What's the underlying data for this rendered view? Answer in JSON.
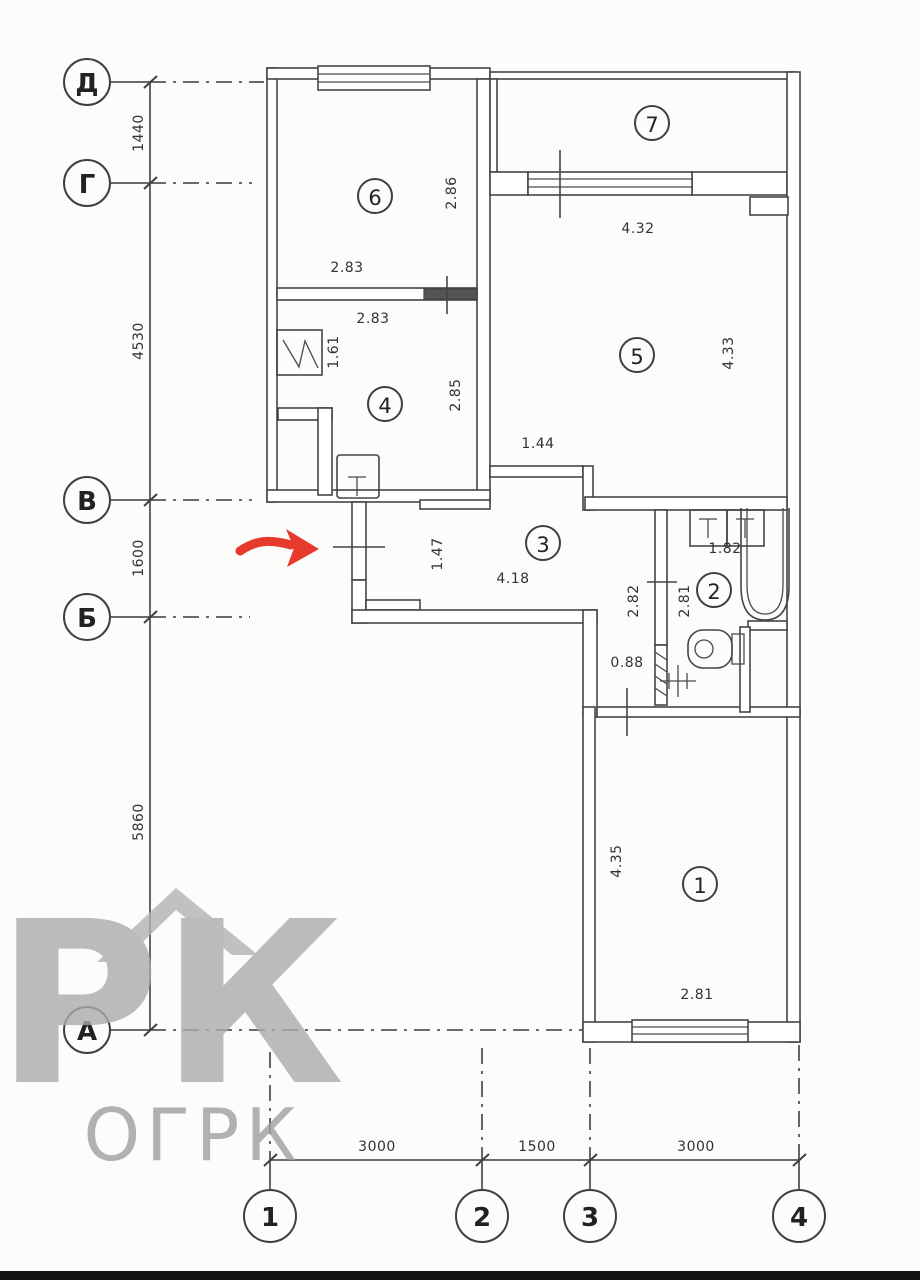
{
  "plan": {
    "rooms": [
      {
        "number": "1"
      },
      {
        "number": "2"
      },
      {
        "number": "3"
      },
      {
        "number": "4"
      },
      {
        "number": "5"
      },
      {
        "number": "6"
      },
      {
        "number": "7"
      }
    ],
    "dims": {
      "room6_w": "2.83",
      "room6_h": "2.86",
      "room4_w": "2.83",
      "room4_h": "2.85",
      "kitchen_sink": "1.61",
      "room5_w": "4.32",
      "room5_h": "4.33",
      "opening_5_3": "1.44",
      "hall_w": "1.47",
      "hall_l": "4.18",
      "wc_left": "2.82",
      "wc_right": "2.81",
      "wc_w": "1.82",
      "niche": "0.88",
      "room1_h": "4.35",
      "room1_w": "2.81"
    },
    "axes": {
      "rows": [
        {
          "label": "Д"
        },
        {
          "label": "Г"
        },
        {
          "label": "В"
        },
        {
          "label": "Б"
        },
        {
          "label": "А"
        }
      ],
      "row_dims": [
        {
          "value": "1440"
        },
        {
          "value": "4530"
        },
        {
          "value": "1600"
        },
        {
          "value": "5860"
        }
      ],
      "cols": [
        {
          "label": "1"
        },
        {
          "label": "2"
        },
        {
          "label": "3"
        },
        {
          "label": "4"
        }
      ],
      "col_dims": [
        {
          "value": "3000"
        },
        {
          "value": "1500"
        },
        {
          "value": "3000"
        }
      ]
    },
    "watermark": {
      "logo": "РК",
      "text": "ОГРК"
    },
    "colors": {
      "line": "#454545",
      "arrow_red": "#e8392d",
      "watermark_gray": "#a3a3a3"
    }
  }
}
